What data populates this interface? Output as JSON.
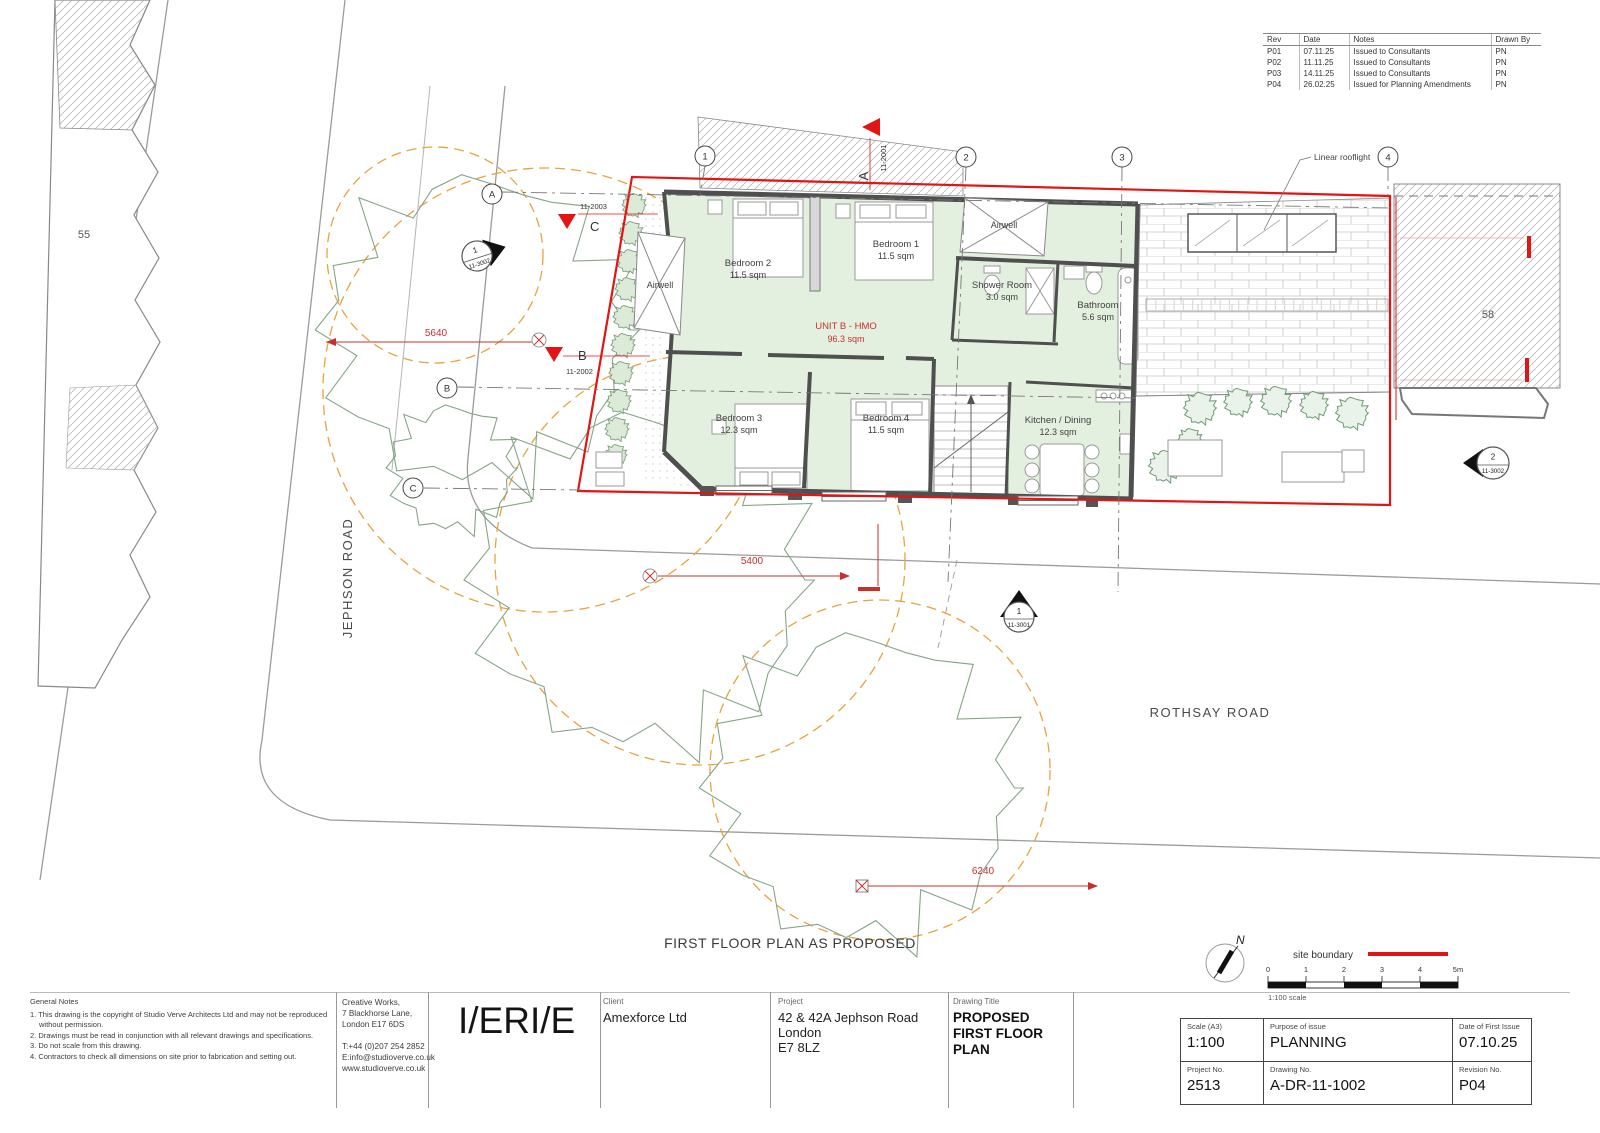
{
  "revision_table": {
    "headers": {
      "rev": "Rev",
      "date": "Date",
      "notes": "Notes",
      "drawn": "Drawn By"
    },
    "rows": [
      {
        "rev": "P01",
        "date": "07.11.25",
        "notes": "Issued to Consultants",
        "drawn": "PN"
      },
      {
        "rev": "P02",
        "date": "11.11.25",
        "notes": "Issued to Consultants",
        "drawn": "PN"
      },
      {
        "rev": "P03",
        "date": "14.11.25",
        "notes": "Issued to Consultants",
        "drawn": "PN"
      },
      {
        "rev": "P04",
        "date": "26.02.25",
        "notes": "Issued for Planning Amendments",
        "drawn": "PN"
      }
    ]
  },
  "plan": {
    "caption": "FIRST FLOOR PLAN AS PROPOSED",
    "unit_label": {
      "name": "UNIT B - HMO",
      "area": "96.3 sqm"
    },
    "rooms": [
      {
        "name": "Bedroom 2",
        "area": "11.5 sqm"
      },
      {
        "name": "Bedroom 1",
        "area": "11.5 sqm"
      },
      {
        "name": "Shower Room",
        "area": "3.0 sqm"
      },
      {
        "name": "Bathroom",
        "area": "5.6 sqm"
      },
      {
        "name": "Bedroom 3",
        "area": "12.3 sqm"
      },
      {
        "name": "Bedroom 4",
        "area": "11.5 sqm"
      },
      {
        "name": "Kitchen / Dining",
        "area": "12.3 sqm"
      }
    ],
    "airwell_label": "Airwell",
    "annotations": {
      "linear_rooflight": "Linear rooflight"
    },
    "dimensions": {
      "d1": "5640",
      "d2": "5400",
      "d3": "6240"
    },
    "grid": {
      "cols": [
        "1",
        "2",
        "3",
        "4"
      ],
      "rows": [
        "A",
        "B",
        "C"
      ]
    },
    "section_markers": [
      {
        "letter": "A",
        "ref": "11-2001"
      },
      {
        "letter": "B",
        "ref": "11-2002"
      },
      {
        "letter": "C",
        "ref": "11-2003"
      }
    ],
    "elevation_markers": [
      {
        "num": "1",
        "ref": "11-3002"
      },
      {
        "num": "2",
        "ref": "11-3002"
      },
      {
        "num": "1",
        "ref": "11-3001"
      }
    ],
    "neighbours": {
      "left": "55",
      "right": "58"
    },
    "roads": {
      "left": "JEPHSON ROAD",
      "bottom": "ROTHSAY ROAD"
    },
    "north_label": "N"
  },
  "legend": {
    "site_boundary": "site boundary",
    "scale_ticks": [
      "0",
      "1",
      "2",
      "3",
      "4",
      "5m"
    ],
    "scale_note": "1:100 scale"
  },
  "title_block": {
    "general_notes_heading": "General Notes",
    "general_notes": [
      "1. This drawing is the copyright of Studio Verve Architects Ltd and may not be reproduced without permission.",
      "2. Drawings must be read in conjunction with all relevant drawings and specifications.",
      "3. Do not scale from this drawing.",
      "4. Contractors to check all dimensions on site prior to fabrication and setting out."
    ],
    "practice": {
      "address": [
        "Creative Works,",
        "7 Blackhorse Lane,",
        "London E17 6DS"
      ],
      "contact": [
        "T:+44 (0)207 254 2852",
        "E:info@studioverve.co.uk",
        "www.studioverve.co.uk"
      ]
    },
    "logo": "I/ERI/E",
    "client": {
      "label": "Client",
      "value": "Amexforce Ltd"
    },
    "project": {
      "label": "Project",
      "lines": [
        "42 & 42A Jephson Road",
        "London",
        "E7 8LZ"
      ]
    },
    "drawing_title": {
      "label": "Drawing Title",
      "lines": [
        "PROPOSED",
        "FIRST FLOOR PLAN"
      ]
    },
    "scale": {
      "label": "Scale (A3)",
      "value": "1:100"
    },
    "purpose": {
      "label": "Purpose of issue",
      "value": "PLANNING"
    },
    "first_issue": {
      "label": "Date of First Issue",
      "value": "07.10.25"
    },
    "project_no": {
      "label": "Project No.",
      "value": "2513"
    },
    "drawing_no": {
      "label": "Drawing No.",
      "value": "A-DR-11-1002"
    },
    "revision_no": {
      "label": "Revision No.",
      "value": "P04"
    }
  },
  "colors": {
    "site_boundary_red": "#e21414",
    "dimension_red": "#c9302c",
    "room_green": "#e4f0df",
    "tree_green": "#87a489",
    "canopy_orange": "#e8a33d",
    "wall_gray": "#4f4f4f"
  }
}
